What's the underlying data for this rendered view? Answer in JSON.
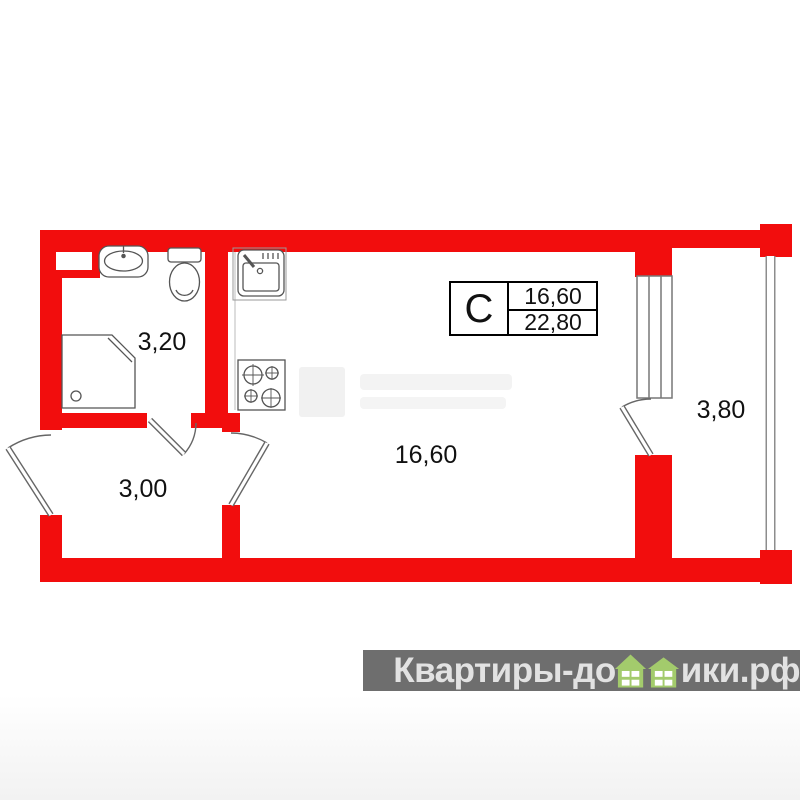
{
  "plan": {
    "rooms": [
      {
        "name": "bathroom",
        "area_label": "3,20"
      },
      {
        "name": "hallway",
        "area_label": "3,00"
      },
      {
        "name": "living-room",
        "area_label": "16,60"
      },
      {
        "name": "balcony",
        "area_label": "3,80"
      }
    ],
    "info_box": {
      "type_label": "С",
      "living_area": "16,60",
      "total_area": "22,80"
    },
    "colors": {
      "wall": "#f20d0d",
      "outline": "#666666",
      "glazing": "#8d8d8d"
    }
  },
  "brand": {
    "text_left": "Квартиры-до",
    "text_right": "ики.рф",
    "bar_color": "#6e6e6e",
    "text_color": "#e2e2e2",
    "house_green": "#a3cb6c"
  }
}
